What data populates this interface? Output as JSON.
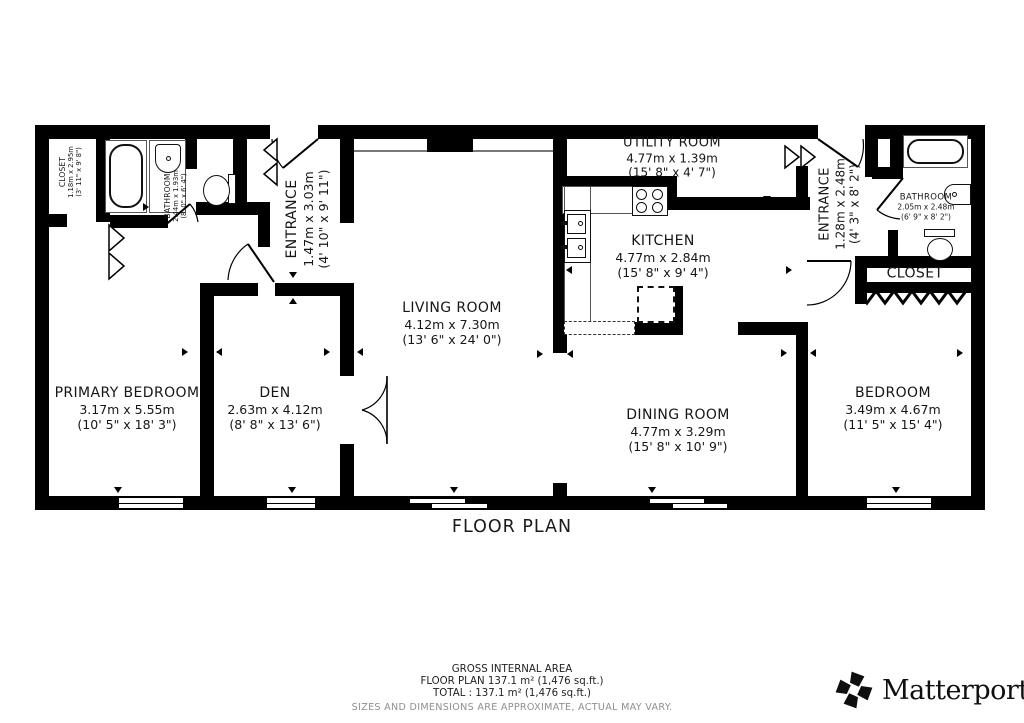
{
  "title": "FLOOR PLAN",
  "rooms": [
    {
      "name": "CLOSET",
      "metric": "1.18m x 2.95m",
      "imperial": "(3' 11\" x 9' 8\")"
    },
    {
      "name": "BATHROOM",
      "metric": "2.44m x 1.93m",
      "imperial": "(8' 0\" x 6' 4\")"
    },
    {
      "name": "ENTRANCE",
      "metric": "1.47m x 3.03m",
      "imperial": "(4' 10\" x 9' 11\")"
    },
    {
      "name": "LIVING ROOM",
      "metric": "4.12m x 7.30m",
      "imperial": "(13' 6\" x 24' 0\")"
    },
    {
      "name": "UTILITY ROOM",
      "metric": "4.77m x 1.39m",
      "imperial": "(15' 8\" x 4' 7\")"
    },
    {
      "name": "KITCHEN",
      "metric": "4.77m x 2.84m",
      "imperial": "(15' 8\" x 9' 4\")"
    },
    {
      "name": "ENTRANCE",
      "metric": "1.28m x 2.48m",
      "imperial": "(4' 3\" x 8' 2\")"
    },
    {
      "name": "BATHROOM",
      "metric": "2.05m x 2.48m",
      "imperial": "(6' 9\" x 8' 2\")"
    },
    {
      "name": "CLOSET"
    },
    {
      "name": "PRIMARY BEDROOM",
      "metric": "3.17m x 5.55m",
      "imperial": "(10' 5\" x 18' 3\")"
    },
    {
      "name": "DEN",
      "metric": "2.63m x 4.12m",
      "imperial": "(8' 8\" x 13' 6\")"
    },
    {
      "name": "DINING ROOM",
      "metric": "4.77m x 3.29m",
      "imperial": "(15' 8\" x 10' 9\")"
    },
    {
      "name": "BEDROOM",
      "metric": "3.49m x 4.67m",
      "imperial": "(11' 5\" x 15' 4\")"
    }
  ],
  "footer": {
    "area_heading": "GROSS INTERNAL AREA",
    "area_line1": "FLOOR PLAN 137.1 m² (1,476 sq.ft.)",
    "area_line2": "TOTAL :  137.1 m² (1,476 sq.ft.)",
    "disclaimer": "SIZES AND DIMENSIONS ARE APPROXIMATE, ACTUAL MAY VARY.",
    "brand": "Matterport",
    "brand_mark": "®"
  },
  "colors": {
    "wall": "#000000",
    "text": "#161616",
    "muted": "#8f8f8f"
  }
}
